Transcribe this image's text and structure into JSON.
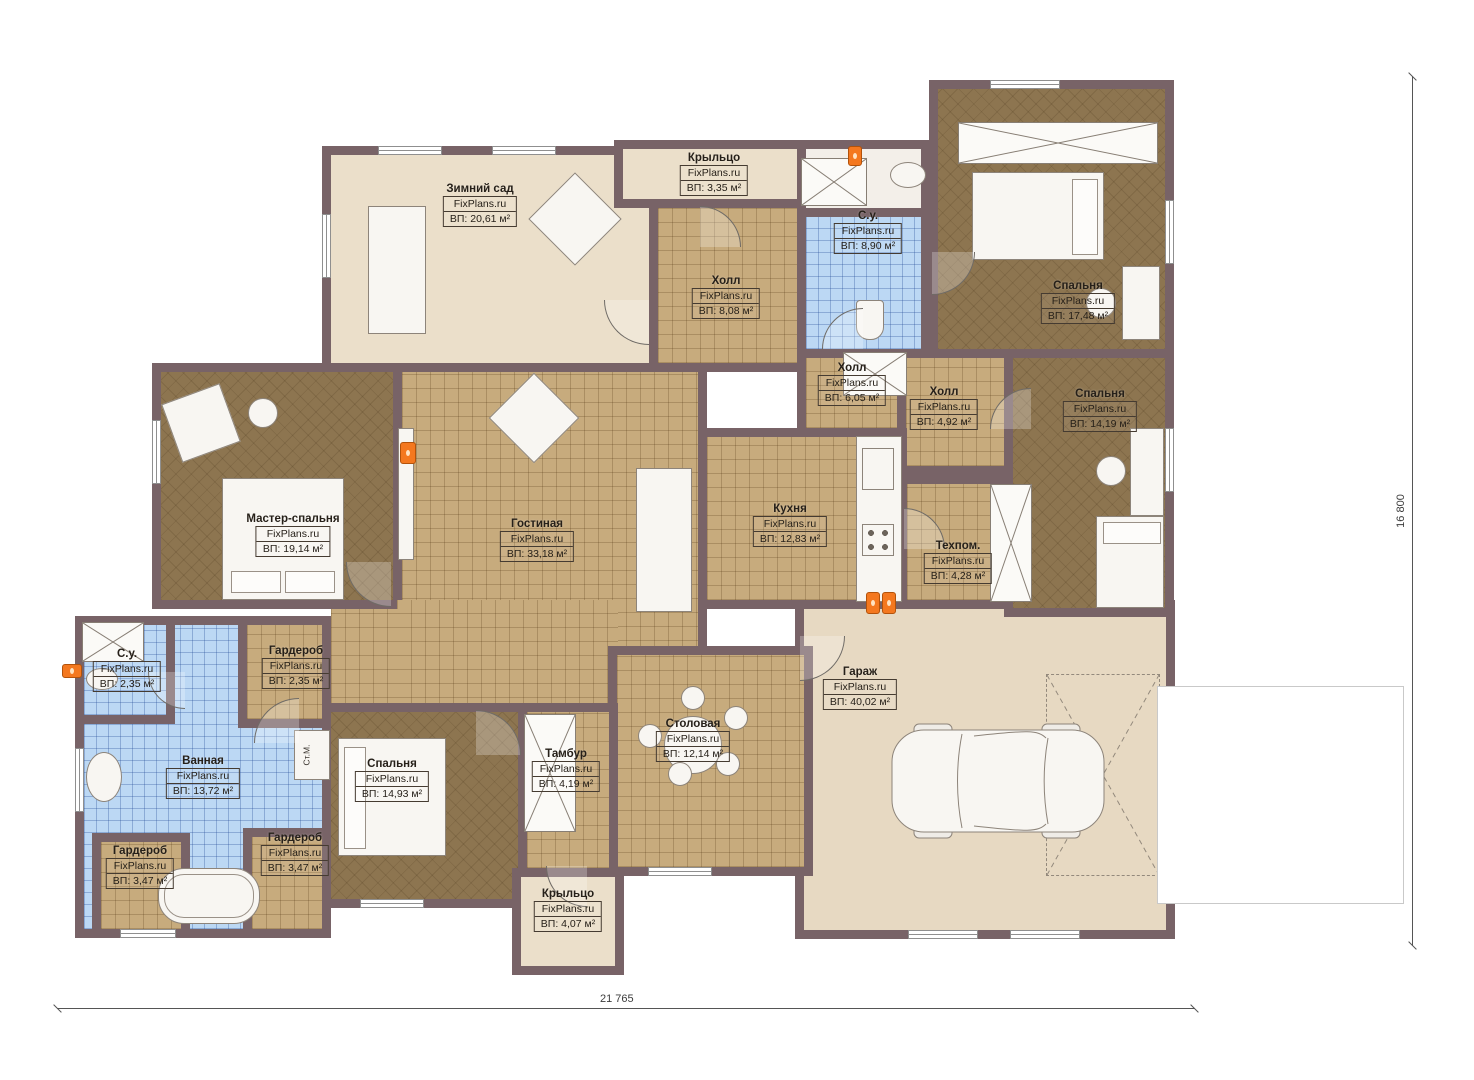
{
  "plan": {
    "brand": "FixPlans.ru",
    "dimensions": {
      "width": "21 765",
      "height": "16 800"
    },
    "annotations": {
      "washing_machine": "Ст.М."
    },
    "rooms": [
      {
        "name": "Зимний сад",
        "area": "ВП: 20,61 м²"
      },
      {
        "name": "Крыльцо",
        "area": "ВП: 3,35 м²"
      },
      {
        "name": "Холл",
        "area": "ВП: 8,08 м²"
      },
      {
        "name": "С.у.",
        "area": "ВП: 8,90 м²"
      },
      {
        "name": "Спальня",
        "area": "ВП: 17,48 м²"
      },
      {
        "name": "Холл",
        "area": "ВП: 6,05 м²"
      },
      {
        "name": "Холл",
        "area": "ВП: 4,92 м²"
      },
      {
        "name": "Спальня",
        "area": "ВП: 14,19 м²"
      },
      {
        "name": "Мастер-спальня",
        "area": "ВП: 19,14 м²"
      },
      {
        "name": "Гостиная",
        "area": "ВП: 33,18 м²"
      },
      {
        "name": "Кухня",
        "area": "ВП: 12,83 м²"
      },
      {
        "name": "Техпом.",
        "area": "ВП: 4,28 м²"
      },
      {
        "name": "С.у.",
        "area": "ВП: 2,35 м²"
      },
      {
        "name": "Гардероб",
        "area": "ВП: 2,35 м²"
      },
      {
        "name": "Ванная",
        "area": "ВП: 13,72 м²"
      },
      {
        "name": "Гардероб",
        "area": "ВП: 3,47 м²"
      },
      {
        "name": "Гардероб",
        "area": "ВП: 3,47 м²"
      },
      {
        "name": "Спальня",
        "area": "ВП: 14,93 м²"
      },
      {
        "name": "Тамбур",
        "area": "ВП: 4,19 м²"
      },
      {
        "name": "Столовая",
        "area": "ВП: 12,14 м²"
      },
      {
        "name": "Крыльцо",
        "area": "ВП: 4,07 м²"
      },
      {
        "name": "Гараж",
        "area": "ВП: 40,02 м²"
      }
    ]
  }
}
